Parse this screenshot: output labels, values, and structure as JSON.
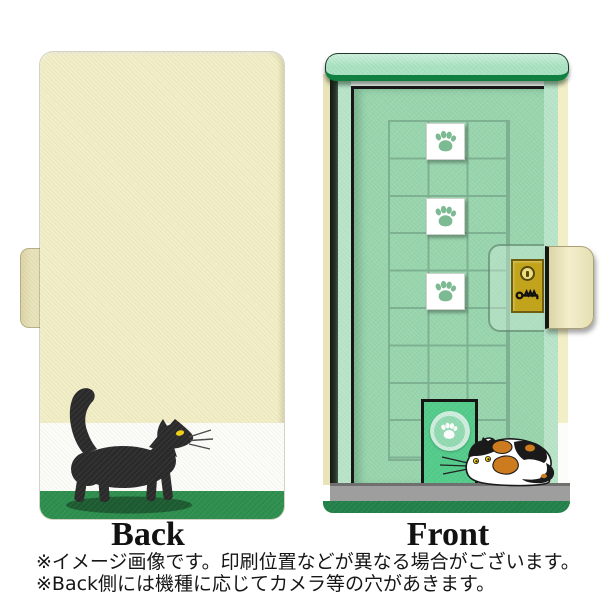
{
  "labels": {
    "back": "Back",
    "front": "Front"
  },
  "notes": [
    "※イメージ画像です。印刷位置などが異なる場合がございます。",
    "※Back側には機種に応じてカメラ等の穴があきます。"
  ],
  "icons": {
    "paw": "paw-print-icon",
    "keyhole": "keyhole-icon",
    "key": "key-icon"
  },
  "colors": {
    "cream": "#f2eec6",
    "cream-edge": "#e9e3ba",
    "back-white-band": "#fcfcf9",
    "back-green-band": "#2e8f4e",
    "cat-black": "#2b2b2b",
    "eye-yellow": "#f2d215",
    "shadow-green": "#1d5c31",
    "awning-green": "#a9e3c1",
    "awning-dark": "#0f8040",
    "jamb-green": "#b9e5c9",
    "door-green": "#99d6ae",
    "grid-green": "#7aab8d",
    "paw-green": "#7cba92",
    "cat-door-green": "#54cc8b",
    "threshold-gray": "#9e9e9e",
    "base-green": "#23814a",
    "lock-gold": "#c2a31c",
    "calico-orange": "#cd7b1f",
    "ink": "#161616"
  }
}
